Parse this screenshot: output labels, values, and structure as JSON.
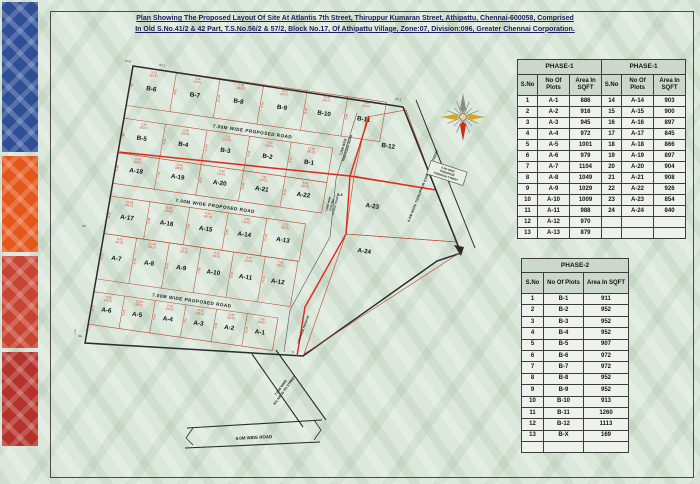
{
  "title": {
    "line1": "Plan Showing The Proposed Layout Of Site At Atlantis 7th Street, Thiruppur Kumaran Street, Athipattu, Chennai-600058, Comprised",
    "line2": "In Old S.No.41/2 & 42 Part, T.S.No.56/2 & 57/2, Block No.17,  Of Athipattu Village, Zone:07, Division:096, Greater Chennai Corporation."
  },
  "colors": {
    "page_bg": "#dce8db",
    "accent_red": "#e02818",
    "plot_line": "#b8442c",
    "boundary": "#2b2b2b",
    "dim_red": "#d8321e",
    "table_header_bg": "#ccd8cb",
    "title_color": "#1c1c5e",
    "strip_tiles": [
      "#2e4f96",
      "#e4571b",
      "#c84432",
      "#b5322a"
    ]
  },
  "plan": {
    "grid_rows": [
      [
        "B-6",
        "B-7",
        "B-8",
        "B-9",
        "B-10",
        "B-11"
      ],
      [
        "B-5",
        "B-4",
        "B-3",
        "B-2",
        "B-1"
      ],
      [
        "A-18",
        "A-19",
        "A-20",
        "A-21",
        "A-22"
      ],
      [
        "A-17",
        "A-16",
        "A-15",
        "A-14",
        "A-13"
      ],
      [
        "A-7",
        "A-8",
        "A-9",
        "A-10",
        "A-11",
        "A-12"
      ],
      [
        "A-6",
        "A-5",
        "A-4",
        "A-3",
        "A-2",
        "A-1"
      ]
    ],
    "right_plots": [
      "B-12",
      "A-23",
      "A-24"
    ],
    "sliver_plot": "B-X",
    "road_label": "7.00M WIDE PROPOSED ROAD",
    "vroad1_lines": [
      "7.20M WIDE",
      "PROPOSED ROAD"
    ],
    "vroad2_lines": [
      "7.30M WIDE",
      "EXISTING",
      "LAYOUT ROAD"
    ],
    "passage": "1.50M WIDE PASSAGE",
    "street_main": "6.0M WIDE THIRUPPUR KUMARAN STREET",
    "street_box_lines": [
      "6.0M WIDE",
      "THIRUPPUR",
      "KUMARAN STREET"
    ],
    "atlantis_lines": [
      "7.50M WIDE",
      "ATLANTIS 7th STREET"
    ],
    "road9": "9.0M WIDE ROAD",
    "dims": [
      "9.15",
      "(30.0')",
      "5.49",
      "(18.0')",
      "7.92",
      "(26.0')",
      "8.53",
      "(28.0')",
      "11.04",
      "(36.2')",
      "6.10",
      "(20.0')"
    ],
    "corner_dim": "1.14",
    "markers": [
      "A1.0",
      "A1.1",
      "A1.1",
      "43",
      "4A",
      "S"
    ]
  },
  "tables": {
    "phase1": {
      "title": "PHASE-1",
      "title2": "PHASE-1",
      "headers": [
        "S.No",
        "No Of Plots",
        "Area In SQFT"
      ],
      "left_rows": [
        [
          "1",
          "A-1",
          "886"
        ],
        [
          "2",
          "A-2",
          "916"
        ],
        [
          "3",
          "A-3",
          "945"
        ],
        [
          "4",
          "A-4",
          "972"
        ],
        [
          "5",
          "A-5",
          "1001"
        ],
        [
          "6",
          "A-6",
          "979"
        ],
        [
          "7",
          "A-7",
          "1104"
        ],
        [
          "8",
          "A-8",
          "1049"
        ],
        [
          "9",
          "A-9",
          "1029"
        ],
        [
          "10",
          "A-10",
          "1009"
        ],
        [
          "11",
          "A-11",
          "988"
        ],
        [
          "12",
          "A-12",
          "970"
        ],
        [
          "13",
          "A-13",
          "879"
        ]
      ],
      "right_rows": [
        [
          "14",
          "A-14",
          "903"
        ],
        [
          "15",
          "A-15",
          "900"
        ],
        [
          "16",
          "A-16",
          "897"
        ],
        [
          "17",
          "A-17",
          "845"
        ],
        [
          "18",
          "A-18",
          "866"
        ],
        [
          "19",
          "A-19",
          "897"
        ],
        [
          "20",
          "A-20",
          "904"
        ],
        [
          "21",
          "A-21",
          "908"
        ],
        [
          "22",
          "A-22",
          "926"
        ],
        [
          "23",
          "A-23",
          "854"
        ],
        [
          "24",
          "A-24",
          "840"
        ]
      ]
    },
    "phase2": {
      "title": "PHASE-2",
      "headers": [
        "S.No",
        "No Of Plots",
        "Area In SQFT"
      ],
      "rows": [
        [
          "1",
          "B-1",
          "911"
        ],
        [
          "2",
          "B-2",
          "952"
        ],
        [
          "3",
          "B-3",
          "952"
        ],
        [
          "4",
          "B-4",
          "952"
        ],
        [
          "5",
          "B-5",
          "907"
        ],
        [
          "6",
          "B-6",
          "972"
        ],
        [
          "7",
          "B-7",
          "972"
        ],
        [
          "8",
          "B-8",
          "952"
        ],
        [
          "9",
          "B-9",
          "952"
        ],
        [
          "10",
          "B-10",
          "913"
        ],
        [
          "11",
          "B-11",
          "1260"
        ],
        [
          "12",
          "B-12",
          "1113"
        ],
        [
          "13",
          "B-X",
          "169"
        ],
        [
          "",
          "",
          ""
        ]
      ]
    }
  }
}
